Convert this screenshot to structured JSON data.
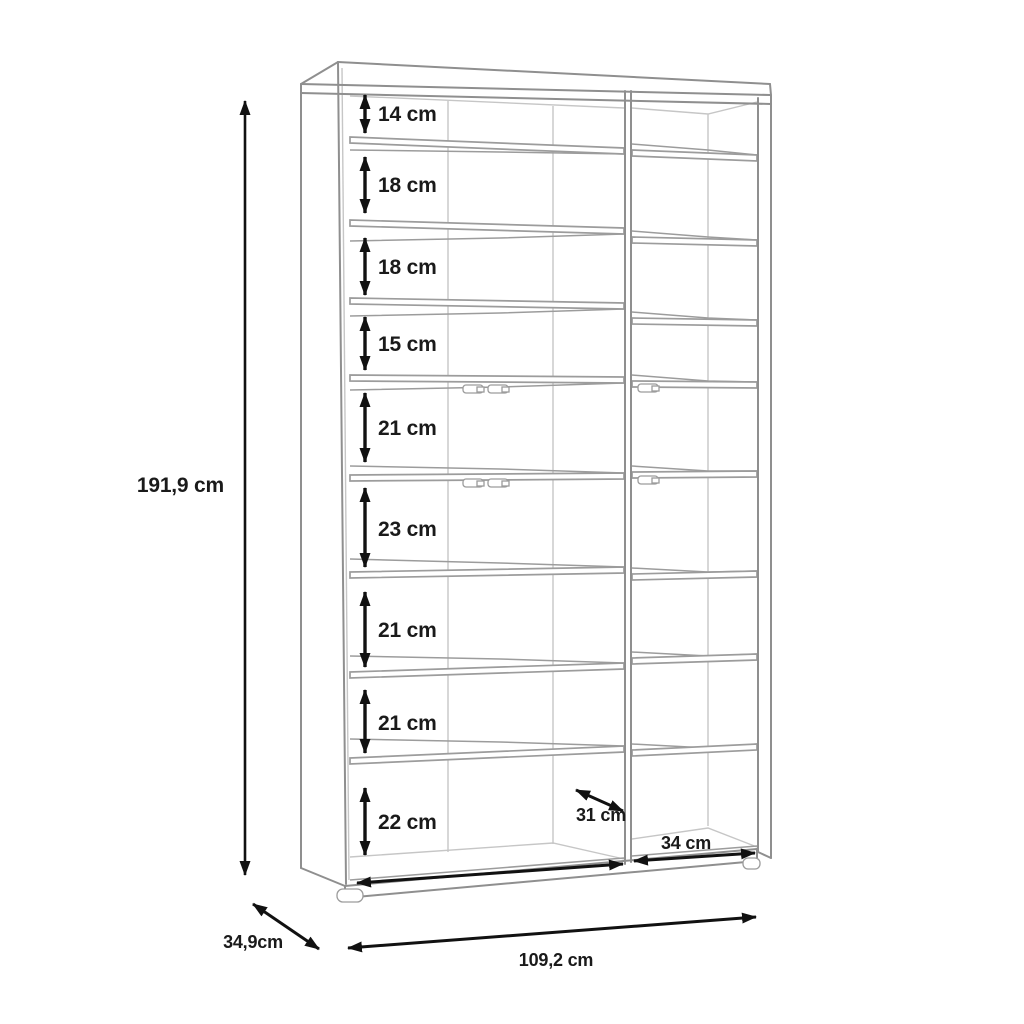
{
  "drawing": {
    "kind": "furniture-dimension-diagram",
    "object": "tall open shelving unit with two columns of compartments, perspective line drawing with dimension arrows"
  },
  "dimensions": {
    "total_height_label": "191,9 cm",
    "total_width_label": "109,2 cm",
    "total_depth_label": "34,9cm",
    "interior_depth_label": "31 cm",
    "right_column_width_label": "34 cm",
    "compartment_labels": [
      "14 cm",
      "18 cm",
      "18 cm",
      "15 cm",
      "21 cm",
      "23 cm",
      "21 cm",
      "21 cm",
      "22 cm"
    ]
  },
  "style": {
    "dimension_color": "#111111",
    "outline_color": "#8f8f8f",
    "interior_line_color": "#c6c6c6",
    "background_color": "#ffffff"
  }
}
